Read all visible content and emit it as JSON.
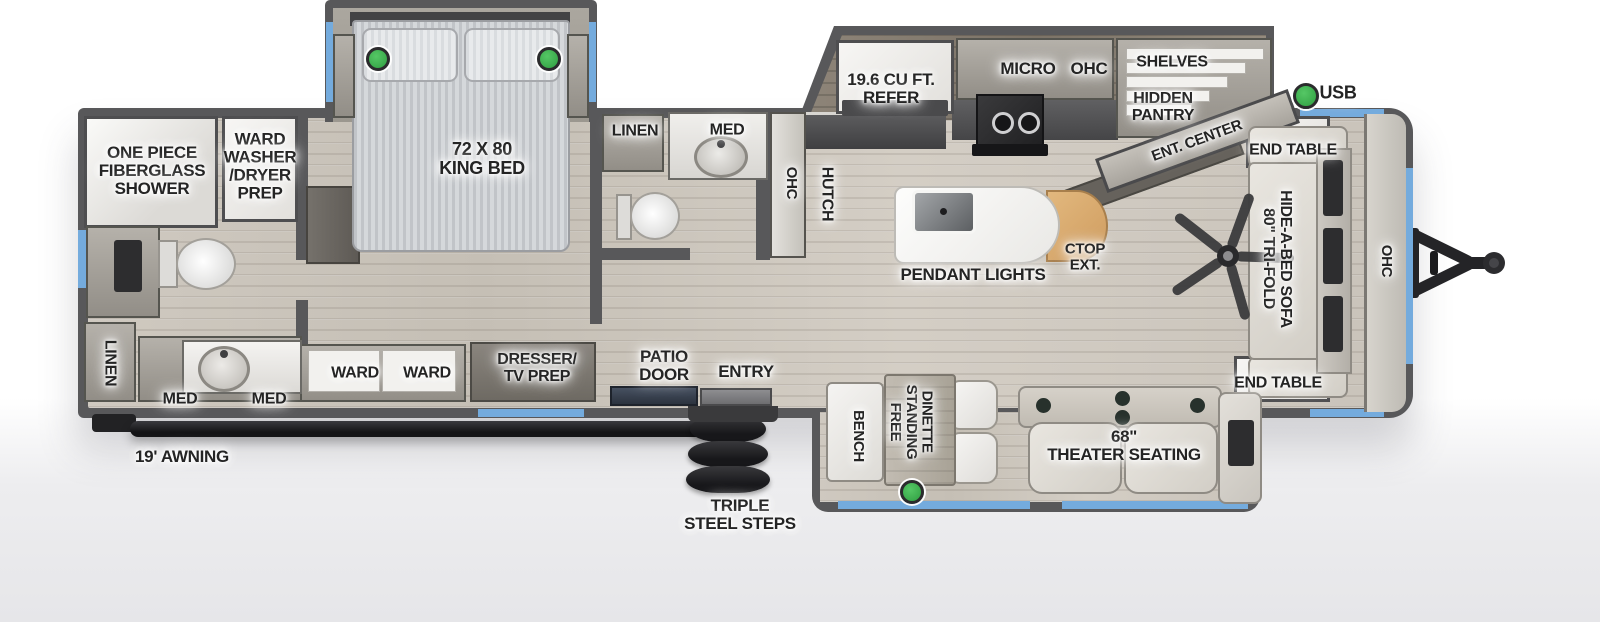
{
  "title": "Travel trailer floorplan",
  "colors": {
    "wall": "#58585a",
    "floor_wood": "#cbc5bc",
    "window_blue": "#74abdd",
    "indicator_green": "#3bb14c",
    "countertop_extension_tan": "#d8a96e",
    "fixture_white": "#f2f1ee",
    "dark_hardware": "#1f1f21"
  },
  "labels": {
    "shower": "ONE PIECE\nFIBERGLASS\nSHOWER",
    "ward_washer": "WARD\nWASHER\n/DRYER\nPREP",
    "king_bed": "72 X 80\nKING BED",
    "linen_rear": "LINEN",
    "med_1": "MED",
    "med_2": "MED",
    "ward_1": "WARD",
    "ward_2": "WARD",
    "dresser": "DRESSER/\nTV PREP",
    "linen_mid": "LINEN",
    "med_mid": "MED",
    "ohc_mid": "OHC",
    "hutch": "HUTCH",
    "refer": "19.6 CU FT.\nREFER",
    "micro": "MICRO",
    "ohc_kitchen": "OHC",
    "shelves": "SHELVES",
    "hidden_pantry": "HIDDEN\nPANTRY",
    "ent_center": "ENT. CENTER",
    "usb": "USB",
    "pendant_lights": "PENDANT LIGHTS",
    "ctop_ext": "CTOP\nEXT.",
    "end_table_top": "END TABLE",
    "sofa": "80\" TRI-FOLD\nHIDE-A-BED SOFA",
    "ohc_front": "OHC",
    "end_table_bottom": "END TABLE",
    "patio_door": "PATIO\nDOOR",
    "entry": "ENTRY",
    "bench": "BENCH",
    "dinette": "FREE\nSTANDING\nDINETTE",
    "theater": "68\"\nTHEATER SEATING",
    "steps": "TRIPLE\nSTEEL STEPS",
    "awning": "19' AWNING"
  }
}
